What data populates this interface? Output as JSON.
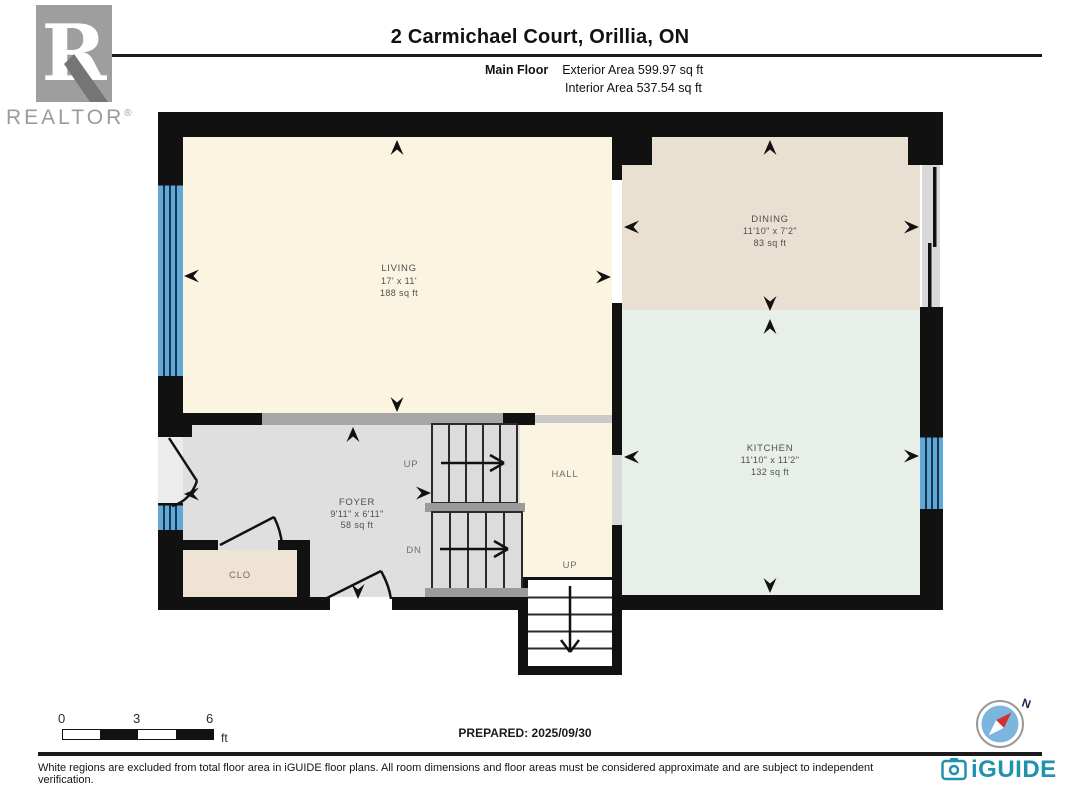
{
  "header": {
    "title": "2 Carmichael Court, Orillia, ON",
    "floor_label": "Main Floor",
    "exterior_area": "Exterior Area 599.97 sq ft",
    "interior_area": "Interior Area 537.54 sq ft"
  },
  "realtor_logo": {
    "letter": "R",
    "wordmark": "REALTOR",
    "registered": "®"
  },
  "rooms": {
    "living": {
      "name": "LIVING",
      "dims": "17' x 11'",
      "area": "188 sq ft",
      "floor_color": "#FAF4E1"
    },
    "dining": {
      "name": "DINING",
      "dims": "11'10\" x 7'2\"",
      "area": "83 sq ft",
      "floor_color": "#EAE0D2"
    },
    "kitchen": {
      "name": "KITCHEN",
      "dims": "11'10\" x 11'2\"",
      "area": "132 sq ft",
      "floor_color": "#E7EFE8"
    },
    "foyer": {
      "name": "FOYER",
      "dims": "9'11\" x 6'11\"",
      "area": "58 sq ft",
      "floor_color": "#DFDFDF"
    },
    "hall": {
      "name": "HALL",
      "floor_color": "#FAF4E1"
    },
    "closet": {
      "name": "CLO",
      "floor_color": "#EFE4D3"
    }
  },
  "stairs": {
    "up_label": "UP",
    "down_label": "DN",
    "hall_up_label": "UP"
  },
  "plan_colors": {
    "wall": "#111111",
    "window": "#5FA8D8",
    "half_wall": "#A6A6A6",
    "stair_fill": "#DCDCDC",
    "landing": "#9B9B9B"
  },
  "footer": {
    "scale_ticks": [
      "0",
      "3",
      "6"
    ],
    "scale_unit": "ft",
    "prepared": "PREPARED: 2025/09/30",
    "disclaimer": "White regions are excluded from total floor area in iGUIDE floor plans. All room dimensions and floor areas must be considered approximate and are subject to independent verification.",
    "compass_north": "N",
    "brand": "iGUIDE"
  }
}
